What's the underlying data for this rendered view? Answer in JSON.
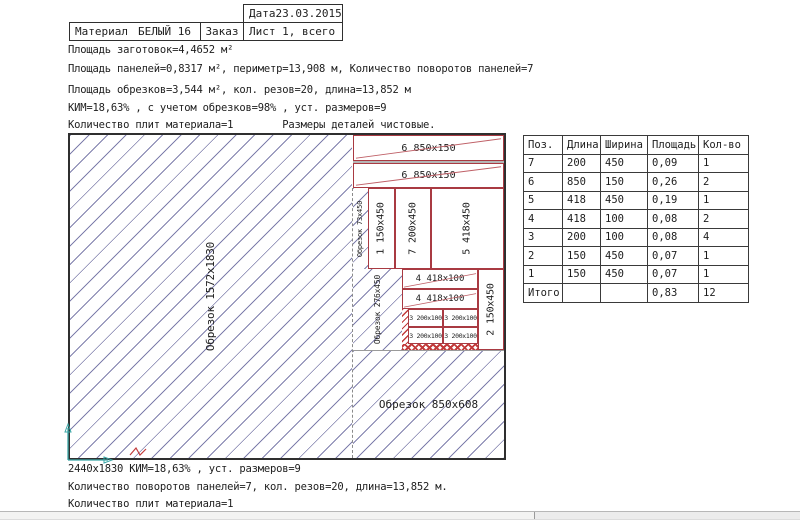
{
  "header": {
    "date_label": "Дата",
    "date_value": "23.03.2015",
    "material_label": "Материал",
    "material_value": "БЕЛЫЙ 16",
    "order_label": "Заказ",
    "sheet_label": "Лист 1, всего 1"
  },
  "info": {
    "lines": [
      "Площадь заготовок=4,4652 м²",
      "Площадь панелей=0,8317 м², периметр=13,908 м, Количество поворотов панелей=7",
      "Площадь обрезков=3,544 м², кол. резов=20, длина=13,852 м",
      "КИМ=18,63% , с учетом обрезков=98% , уст. размеров=9",
      "Количество плит материала=1        Размеры деталей чистовые."
    ]
  },
  "plate": {
    "sheet_size": "2440x1830",
    "offcut_main": "Обрезок 1572x1830",
    "offcut_73": "Обрезок 73x450",
    "offcut_276": "Обрезок 276x450",
    "offcut_bottom": "Обрезок 850x608",
    "strip1": "6  850x150",
    "strip2": "6  850x150",
    "p1": "1 150x450",
    "p7": "7 200x450",
    "p5": "5 418x450",
    "s4a": "4  418x100",
    "s4b": "4  418x100",
    "g1": "3 200x100",
    "g2": "3 200x100",
    "g3": "3 200x100",
    "g4": "3 200x100",
    "p2": "2 150x450"
  },
  "cut_table": {
    "headers": [
      "Поз.",
      "Длина",
      "Ширина",
      "Площадь",
      "Кол-во"
    ],
    "rows": [
      [
        "7",
        "200",
        "450",
        "0,09",
        "1"
      ],
      [
        "6",
        "850",
        "150",
        "0,26",
        "2"
      ],
      [
        "5",
        "418",
        "450",
        "0,19",
        "1"
      ],
      [
        "4",
        "418",
        "100",
        "0,08",
        "2"
      ],
      [
        "3",
        "200",
        "100",
        "0,08",
        "4"
      ],
      [
        "2",
        "150",
        "450",
        "0,07",
        "1"
      ],
      [
        "1",
        "150",
        "450",
        "0,07",
        "1"
      ],
      [
        "Итого",
        "",
        "",
        "0,83",
        "12"
      ]
    ]
  },
  "footer": {
    "lines": [
      "2440x1830 КИМ=18,63% , уст. размеров=9",
      "Количество поворотов панелей=7, кол. резов=20, длина=13,852 м.",
      "Количество плит материала=1"
    ]
  },
  "colors": {
    "panel_border": "#a93a42",
    "diagonal_mark": "#bf5f66",
    "hatch": "#68689e",
    "waste": "#c23b3b",
    "axis": "#3aa6a6",
    "outline": "#2f2f2f"
  }
}
